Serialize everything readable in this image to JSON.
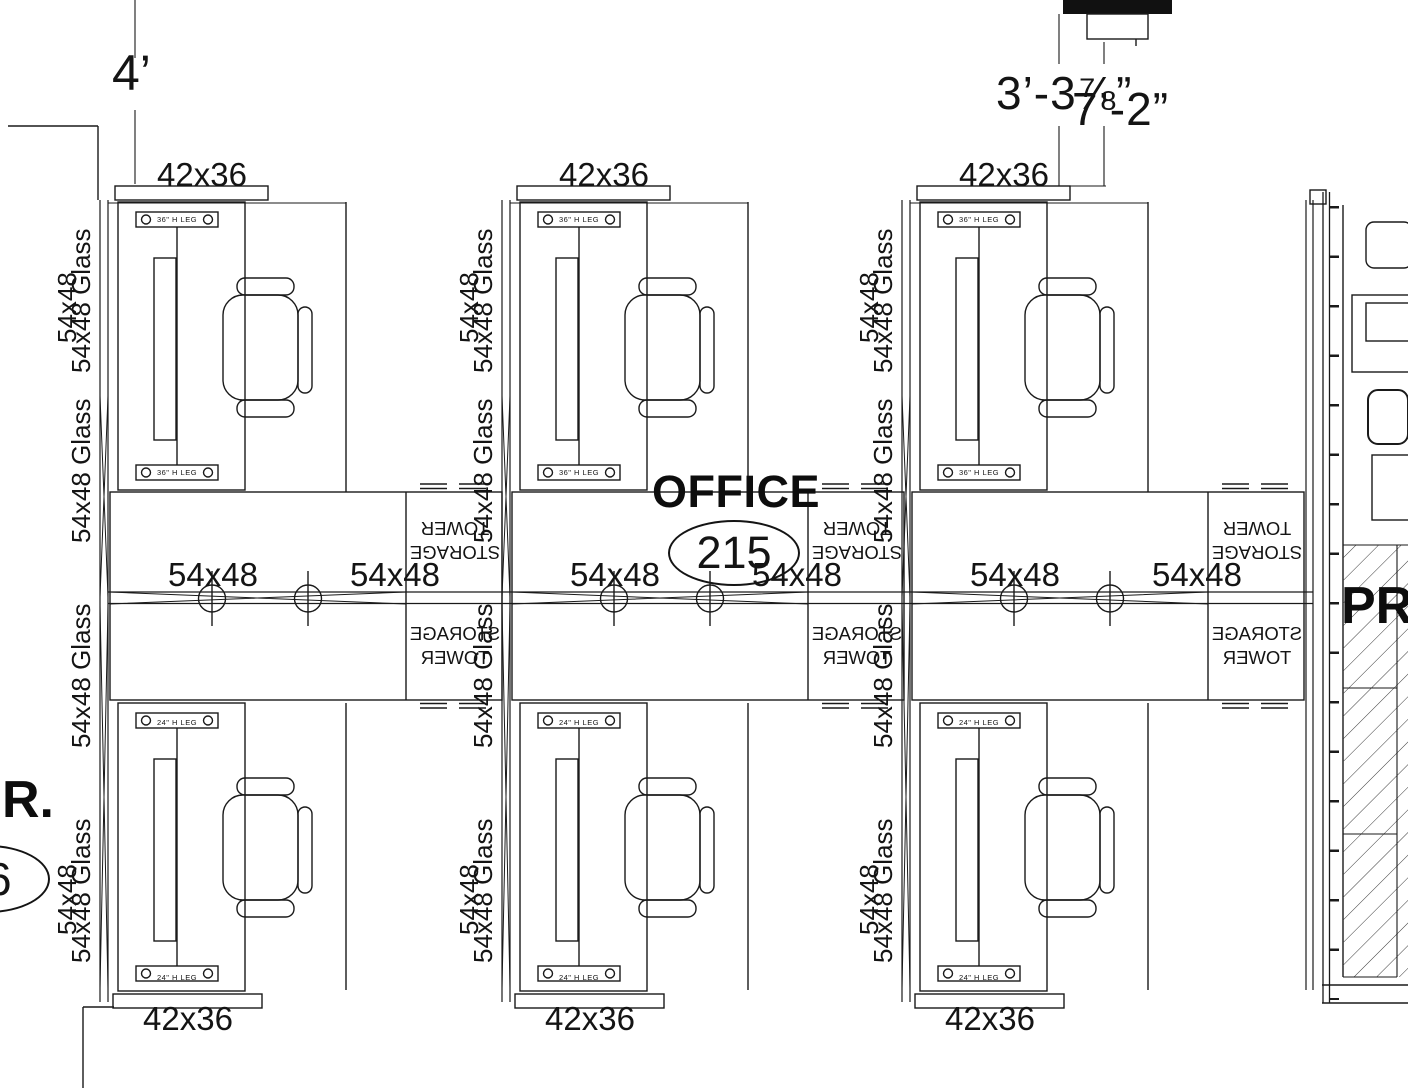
{
  "drawing": {
    "room_label": "OFFICE",
    "room_number": "215",
    "left_room_label": "R.",
    "left_room_bubble_digit": "6",
    "right_area_label": "PR",
    "dim_left": "4’",
    "dim_right_a": "3’-3⅞”",
    "dim_right_b": "7’-2”",
    "overhead_label": "42x36",
    "worksurface_label": "54x48",
    "glass_label": "54x48 Glass",
    "glass_ghost_label": "54x48",
    "storage_line1": "STORAGE",
    "storage_line2": "TOWER",
    "desk_top_leg_label": "36\" H LEG",
    "desk_bottom_leg_label": "24\" H LEG"
  }
}
